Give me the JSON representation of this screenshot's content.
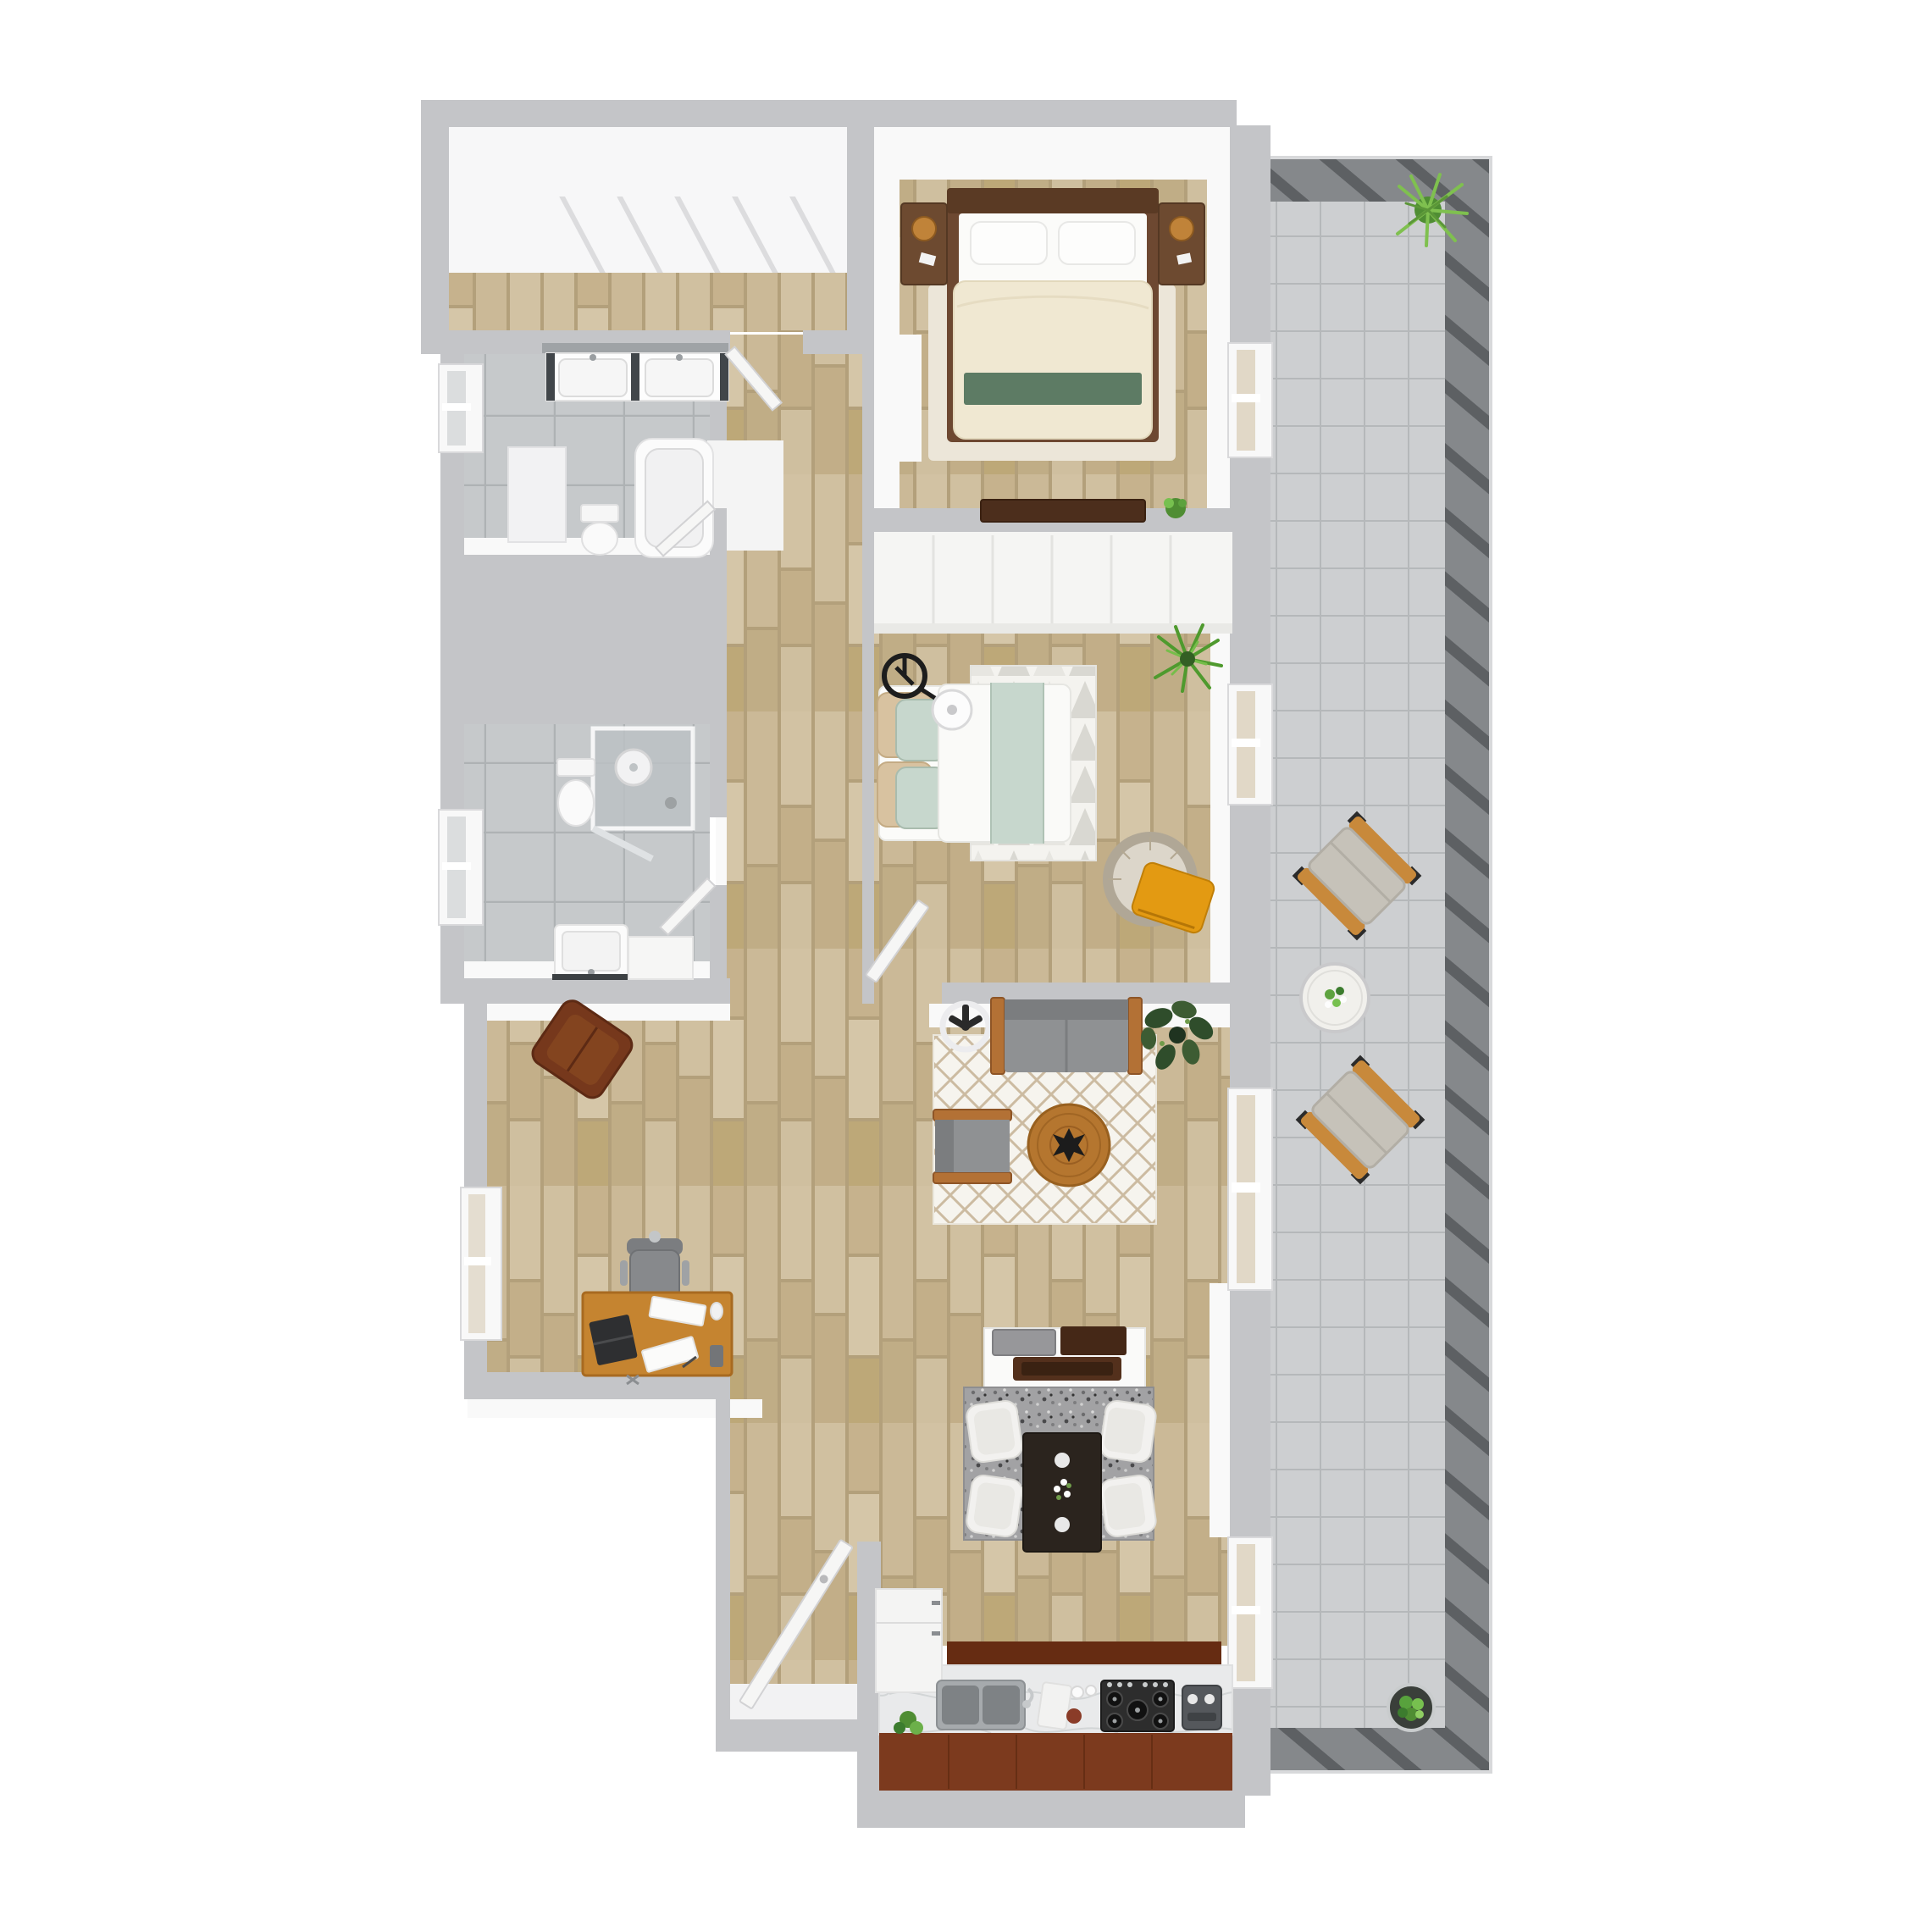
{
  "meta": {
    "type": "3d-floor-plan-top-view",
    "unit": "2-bedroom 2-bathroom apartment with balcony"
  },
  "palette": {
    "bg": "#ffffff",
    "wall": "#c4c5c8",
    "wall-face": "#f9f9f9",
    "wood-base": "#b3a07b",
    "bath-tile": "#c6c9cb",
    "balcony-tile": "#cdcfd1",
    "railing": "#85888b",
    "railing-slat": "#5d6063",
    "railing-trim": "#d8d9db",
    "marble": "#e9eaeb",
    "cherry": "#7c3a1e",
    "cherry-dark": "#662c12",
    "cabinet-white": "#f4f4f3",
    "door": "#f6f6f5",
    "door-edge": "#d2d2d4",
    "sofa": "#8f9193",
    "sofa-dark": "#7b7d7f",
    "arm-wood": "#b37135",
    "rug-cream": "#f6f4ee",
    "trellis-line": "#ccbba1",
    "rug-bed1": "#ece6d9",
    "diamond": "#d9d8d2",
    "rug-dining": "#a2a2a4",
    "table-wood": "#b5762f",
    "espresso": "#2b241e",
    "chair-white": "#f2f1ef",
    "headboard": "#5a3a24",
    "bed-frame": "#6d4831",
    "duvet-cream": "#f0e8d2",
    "bed-green": "#5d7b64",
    "mint": "#c7d7cd",
    "pillow-tan": "#d8c2a0",
    "white-linen": "#fbfbf9",
    "nightstand": "#6d4a30",
    "lamp": "#c08339",
    "dresser": "#4c2e1c",
    "desk-wood": "#c58430",
    "chair-gray": "#87898c",
    "lounge-brown": "#76381c",
    "papasan-ring": "#b0a796",
    "papasan-cushion": "#dcd6ca",
    "throw-orange": "#e39a12",
    "plant-green": "#5da23e",
    "plant-dark": "#2f4d2b",
    "plant-light": "#7fc04f",
    "steel": "#a6aaad",
    "steel-dark": "#7e8285",
    "cooktop": "#2d2d2d",
    "island-white": "#fafaf9",
    "tray-brown": "#53301c",
    "fan-black": "#2a2a2a",
    "shower-glass": "#bcc1c4",
    "outdoor-wood": "#c8893b",
    "outdoor-cushion": "#c6c2b9"
  },
  "rooms": [
    {
      "id": "walk-in-closet",
      "name": "walk-in closet",
      "floor": "wood + shelving"
    },
    {
      "id": "primary-bedroom",
      "name": "primary bedroom",
      "floor": "wood"
    },
    {
      "id": "bathroom-main",
      "name": "main bathroom (double vanity, tub)",
      "floor": "gray tile"
    },
    {
      "id": "bathroom-second",
      "name": "second bathroom (shower)",
      "floor": "gray tile"
    },
    {
      "id": "hallway",
      "name": "hallway",
      "floor": "wood"
    },
    {
      "id": "second-bedroom",
      "name": "second bedroom",
      "floor": "wood"
    },
    {
      "id": "living-room",
      "name": "living room",
      "floor": "wood"
    },
    {
      "id": "office-nook",
      "name": "desk / office nook",
      "floor": "wood"
    },
    {
      "id": "dining-area",
      "name": "dining area",
      "floor": "wood"
    },
    {
      "id": "kitchen",
      "name": "galley kitchen",
      "floor": "wood"
    },
    {
      "id": "entry",
      "name": "entry",
      "floor": "wood"
    },
    {
      "id": "balcony",
      "name": "balcony / terrace",
      "floor": "concrete tile"
    }
  ],
  "furniture": {
    "primary_bedroom": [
      "king bed with green runner",
      "2 nightstands",
      "2 table lamps",
      "area rug",
      "low dresser",
      "small plant"
    ],
    "second_bedroom": [
      "queen bed with mint runner",
      "tan and mint pillows",
      "diamond-pattern rug",
      "arc floor lamp",
      "papasan chair with orange throw",
      "spiky plant",
      "wall closet"
    ],
    "bathroom_main": [
      "double vanity with mirror",
      "bathtub",
      "toilet",
      "partition wall"
    ],
    "bathroom_second": [
      "glass shower",
      "toilet",
      "single vanity",
      "side cabinet"
    ],
    "living_room": [
      "gray sofa with wood arms",
      "gray armchair",
      "round wood coffee table",
      "trellis rug",
      "fiddle-leaf plant",
      "ceiling fan"
    ],
    "office_nook": [
      "wood desk with laptop and papers",
      "office chair",
      "brown lounge chair"
    ],
    "dining_area": [
      "dark wood dining table",
      "4 white chairs",
      "speckled gray rug",
      "white sideboard island with trays"
    ],
    "kitchen": [
      "double stainless sink",
      "5-burner gas cooktop",
      "coffee machine",
      "marble counter",
      "cherry cabinets",
      "tall white cabinet",
      "small plant"
    ],
    "balcony": [
      "2 outdoor lounge chairs",
      "round bistro table",
      "potted fern",
      "round potted plant"
    ],
    "entry": [
      "front door (open)"
    ]
  }
}
